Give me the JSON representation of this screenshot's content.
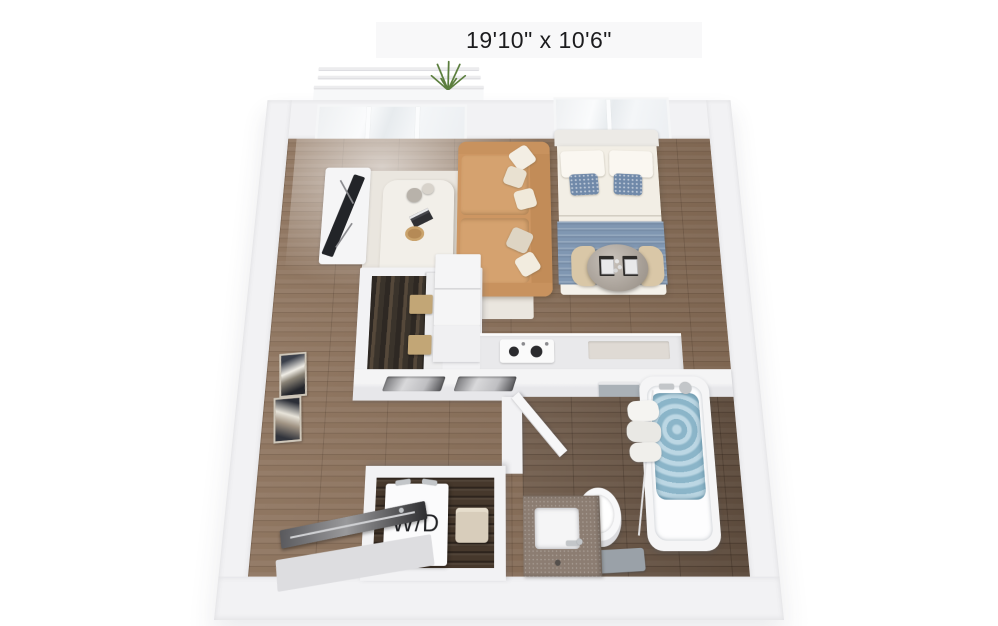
{
  "floorplan": {
    "dimension_label": "19'10\" x 10'6\"",
    "washer_dryer_label": "W/D",
    "view": "3d-top-down-studio-floor-plan",
    "colors": {
      "background": "#ffffff",
      "wall": "#f2f2f4",
      "wood_floor": "#8a6f58",
      "wood_floor_dark": "#6d5847",
      "laundry_wood": "#46382c",
      "rug": "#eae6df",
      "sofa": "#cd9662",
      "sofa_cushion": "#d5a26f",
      "bed_duvet": "#f2eee5",
      "bed_blanket": "#8097b2",
      "accent_pillow": "#7089a9",
      "dining_table": "#ada398",
      "chair": "#d9c7a7",
      "storage_box": "#c2a676",
      "tub_water": "#9fc6d8",
      "vanity_counter": "#8c7d72",
      "closet_interior": "#3f372e",
      "entry_door": "#46464a",
      "towel_gray": "#aab1b7",
      "plant": "#5a7d3c",
      "label_text": "#1c1c1e"
    },
    "objects": [
      "balcony-railing",
      "plant",
      "glass-wall",
      "window",
      "tv-console",
      "tv",
      "area-rug",
      "coffee-table",
      "vases",
      "book",
      "tray",
      "sofa",
      "throw-pillows",
      "bed",
      "bed-pillows",
      "accent-pillows",
      "blanket",
      "dining-table",
      "place-settings",
      "dining-chairs",
      "wardrobe-closet",
      "hanging-clothes",
      "storage-boxes",
      "refrigerator",
      "kitchen-counter",
      "stove",
      "wall-niches",
      "framed-wall-art",
      "bathroom-door",
      "towel-bar",
      "bathtub",
      "tub-water",
      "shower-fixtures",
      "shower-curtain-rod",
      "towels",
      "toilet",
      "bath-mat",
      "vanity-sink",
      "faucet",
      "washer-dryer",
      "laundry-basket",
      "entry-door"
    ]
  }
}
